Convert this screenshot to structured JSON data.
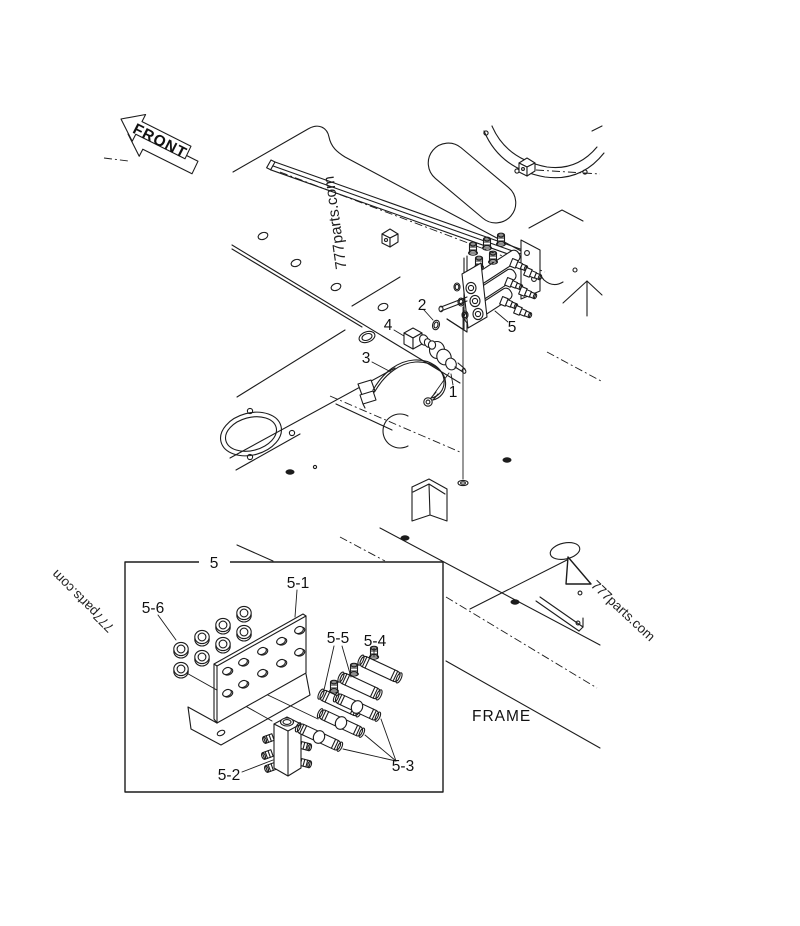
{
  "page": {
    "background": "#ffffff",
    "line_color": "#1c1c1c"
  },
  "labels": {
    "front": "FRONT",
    "frame": "FRAME"
  },
  "watermarks": {
    "top": "777parts.com",
    "left": "777parts.com",
    "right": "777parts.com"
  },
  "callouts": {
    "part1": "1",
    "part2": "2",
    "part3": "3",
    "part4": "4",
    "part5": "5"
  },
  "inset": {
    "box_label": "5",
    "part5_1": "5-1",
    "part5_2": "5-2",
    "part5_3": "5-3",
    "part5_4": "5-4",
    "part5_5": "5-5",
    "part5_6": "5-6"
  }
}
